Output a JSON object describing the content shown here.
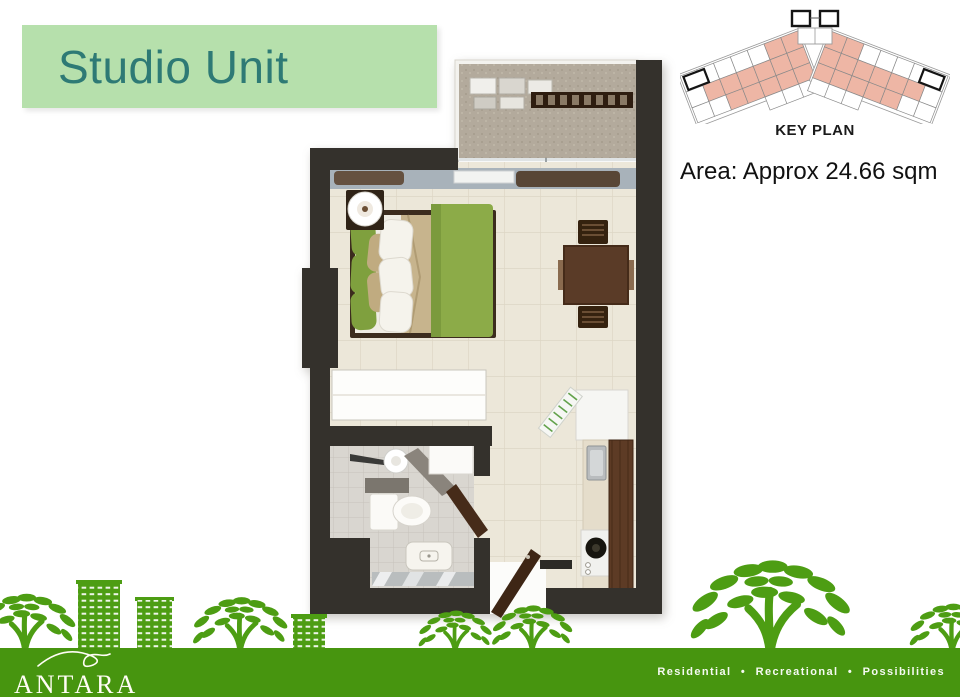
{
  "slide": {
    "title": "Studio Unit",
    "area_label": "Area: Approx 24.66 sqm",
    "key_plan": {
      "label": "KEY PLAN",
      "highlight_color": "#eeb6a5"
    },
    "footer": {
      "logo": "ANTARA",
      "tagline": "Residential • Recreational • Possibilities"
    },
    "colors": {
      "title_bg": "#b6e0ac",
      "title_text": "#2e7a75",
      "footer_green": "#47950f",
      "silhouette_green": "#4d9d13",
      "wall_charcoal": "#34312c",
      "floor_cream": "#ece7d9",
      "bath_tile_gray": "#d9d6d0",
      "bed_duvet_green": "#8cab48",
      "wood_brown": "#5a3b26"
    }
  }
}
